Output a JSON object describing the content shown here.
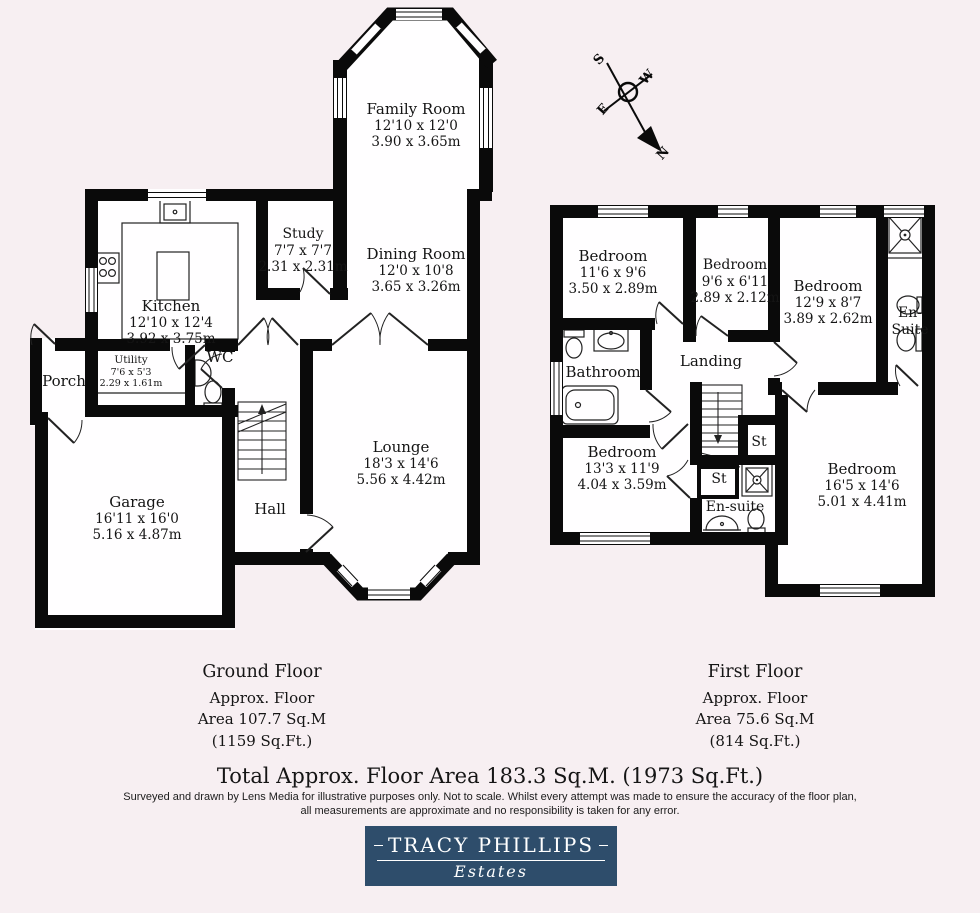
{
  "colors": {
    "background": "#f7eff2",
    "wall": "#0a0a0a",
    "logo_bg": "#2e4d6b",
    "logo_text": "#ffffff"
  },
  "compass": {
    "north": "N",
    "south": "S",
    "east": "E",
    "west": "W"
  },
  "gf": {
    "title": "Ground Floor",
    "approx_line": "Approx. Floor",
    "area_sqm": "Area 107.7 Sq.M",
    "area_sqft": "(1159 Sq.Ft.)",
    "rooms": {
      "family_room": {
        "name": "Family Room",
        "imperial": "12'10  x 12'0",
        "metric": "3.90 x 3.65m"
      },
      "study": {
        "name": "Study",
        "imperial": "7'7  x 7'7",
        "metric": "2.31 x 2.31m"
      },
      "dining_room": {
        "name": "Dining Room",
        "imperial": "12'0  x 10'8",
        "metric": "3.65 x 3.26m"
      },
      "kitchen": {
        "name": "Kitchen",
        "imperial": "12'10  x 12'4",
        "metric": "3.92 x 3.75m"
      },
      "utility": {
        "name": "Utility",
        "imperial": "7'6  x 5'3",
        "metric": "2.29 x 1.61m"
      },
      "wc": {
        "name": "WC"
      },
      "porch": {
        "name": "Porch"
      },
      "garage": {
        "name": "Garage",
        "imperial": "16'11  x 16'0",
        "metric": "5.16 x 4.87m"
      },
      "hall": {
        "name": "Hall"
      },
      "lounge": {
        "name": "Lounge",
        "imperial": "18'3  x 14'6",
        "metric": "5.56 x 4.42m"
      }
    }
  },
  "ff": {
    "title": "First Floor",
    "approx_line": "Approx. Floor",
    "area_sqm": "Area 75.6 Sq.M",
    "area_sqft": "(814 Sq.Ft.)",
    "rooms": {
      "bedroom1": {
        "name": "Bedroom",
        "imperial": "11'6   x 9'6",
        "metric": "3.50 x 2.89m"
      },
      "bedroom2": {
        "name": "Bedroom",
        "imperial": "9'6 x 6'11",
        "metric": "2.89 x 2.12m"
      },
      "bedroom3": {
        "name": "Bedroom",
        "imperial": "12'9 x 8'7",
        "metric": "3.89 x 2.62m"
      },
      "ensuite_top": {
        "name_line1": "En-",
        "name_line2": "Suite"
      },
      "bathroom": {
        "name": "Bathroom"
      },
      "landing": {
        "name": "Landing"
      },
      "bedroom4": {
        "name": "Bedroom",
        "imperial": "13'3 x 11'9",
        "metric": "4.04 x 3.59m"
      },
      "st_upper": {
        "name": "St"
      },
      "st_lower": {
        "name": "St"
      },
      "ensuite_bottom": {
        "name": "En-suite"
      },
      "bedroom5": {
        "name": "Bedroom",
        "imperial": "16'5 x 14'6",
        "metric": "5.01 x 4.41m"
      }
    }
  },
  "summary": {
    "total": "Total Approx. Floor Area 183.3 Sq.M. (1973 Sq.Ft.)",
    "disclaimer_line1": "Surveyed and drawn by Lens Media for illustrative purposes only. Not to scale. Whilst every attempt was made to ensure the accuracy of the floor plan,",
    "disclaimer_line2": "all measurements are approximate and no responsibility is taken for any error."
  },
  "logo": {
    "brand": "TRACY PHILLIPS",
    "division": "Estates"
  }
}
